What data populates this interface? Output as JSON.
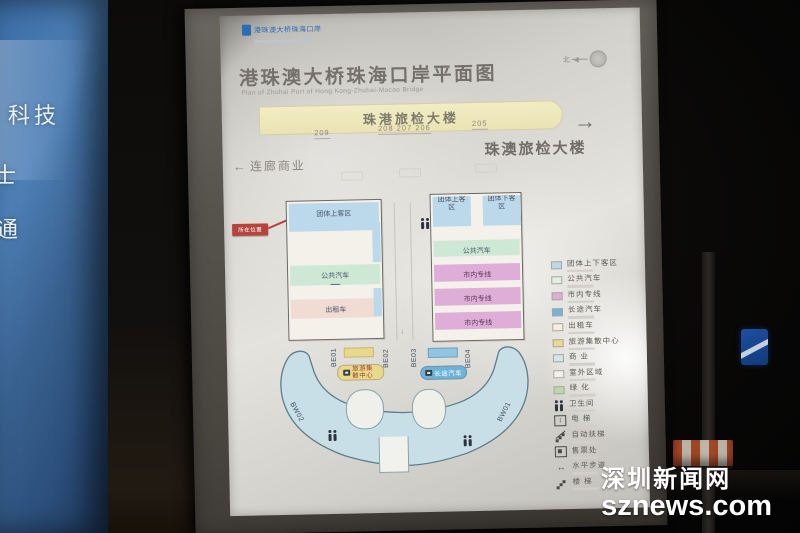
{
  "scene": {
    "left_panel_lines": [
      "科技",
      "士",
      "通"
    ],
    "watermark": {
      "cn": "深圳新闻网",
      "en": "sznews.com"
    }
  },
  "poster": {
    "logo_text": "港珠澳大桥珠海口岸",
    "title": "港珠澳大桥珠海口岸平面图",
    "subtitle_en": "Plan of Zhuhai Port of Hong Kong-Zhuhai-Macao Bridge",
    "compass_north": "北",
    "terminal_bar": {
      "label": "珠港旅检大楼",
      "numbers": [
        "209",
        "208  207  206",
        "205"
      ]
    },
    "exit_right": {
      "arrow": "→",
      "label": "珠澳旅检大楼"
    },
    "corridor_left": {
      "arrow": "←",
      "label": "连廊商业"
    },
    "you_are_here": "所在位置"
  },
  "map": {
    "left_building": {
      "top": "团体上客区",
      "bus": "公共汽车",
      "taxi": "出租车"
    },
    "right_building": {
      "top_left": "团体上客区",
      "top_right": "团体下客区",
      "bus": "公共汽车",
      "city_line": "市内专线"
    },
    "crescent": {
      "gates_top": [
        "BE01",
        "BE02",
        "BE03",
        "BE04"
      ],
      "gate_left": "BW02",
      "gate_right": "BW01",
      "tourist_center": "旅游集散中心",
      "coach": "长途汽车"
    }
  },
  "legend": {
    "items": [
      {
        "type": "swatch",
        "color": "#bcd9ec",
        "label": "团体上下客区"
      },
      {
        "type": "swatch",
        "color": "#e2efe2",
        "label": "公共汽车"
      },
      {
        "type": "swatch",
        "color": "#dfaed8",
        "label": "市内专线"
      },
      {
        "type": "swatch",
        "color": "#74b3da",
        "label": "长途汽车"
      },
      {
        "type": "swatch",
        "color": "#f3efe6",
        "label": "出租车"
      },
      {
        "type": "swatch",
        "color": "#ecd88e",
        "label": "旅游集散中心"
      },
      {
        "type": "swatch",
        "color": "#cfe8ea",
        "label": "商 业"
      },
      {
        "type": "swatch",
        "color": "#f2f0ea",
        "label": "室外区域"
      },
      {
        "type": "swatch",
        "color": "#bcd8a8",
        "label": "绿 化"
      },
      {
        "type": "icon",
        "icon": "restroom-icon",
        "label": "卫生间"
      },
      {
        "type": "icon",
        "icon": "elevator-icon",
        "label": "电 梯",
        "glyph": "↕"
      },
      {
        "type": "icon",
        "icon": "escalator-icon",
        "label": "自动扶梯"
      },
      {
        "type": "icon",
        "icon": "ticket-office-icon",
        "label": "售票处"
      },
      {
        "type": "icon",
        "icon": "moving-walkway-icon",
        "label": "水平步道",
        "glyph": "↔"
      },
      {
        "type": "icon",
        "icon": "stairs-icon",
        "label": "楼 梯"
      }
    ]
  },
  "colors": {
    "group_blue": "#bcd9ec",
    "bus_green": "#cde8d5",
    "city_pink": "#dfaed8",
    "coach_blue": "#74b3da",
    "center_yellow": "#ead98a",
    "crescent_blue": "#c9dfe8",
    "bar_yellow": "#f2ecc4",
    "alert_red": "#b5453c"
  }
}
